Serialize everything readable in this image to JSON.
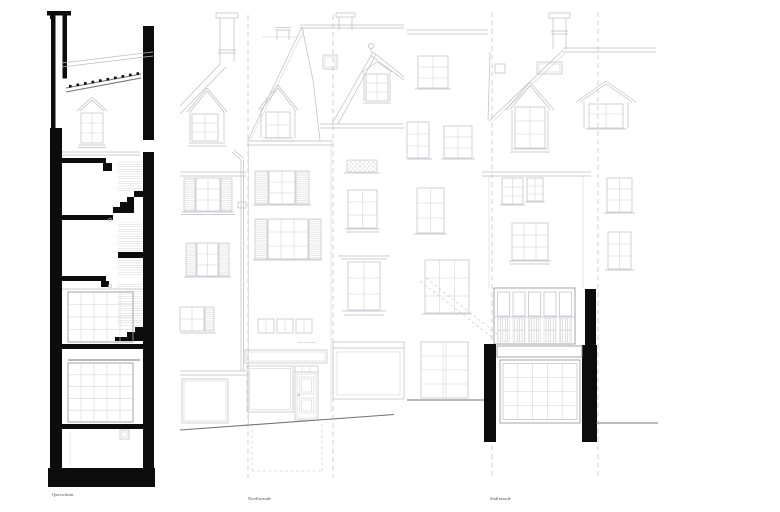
{
  "drawings": [
    {
      "id": "querschnitt",
      "label": "Querschnitt"
    },
    {
      "id": "nordfassade",
      "label": "Nordfassade"
    },
    {
      "id": "suedfassade",
      "label": "Südfassade"
    }
  ],
  "colors": {
    "paper": "#ffffff",
    "ink": "#0c0c0c",
    "line_xlight": "#d4d4d8",
    "line_light": "#bdbdc3",
    "line_mid": "#9c9ca2",
    "line_dark": "#74747b",
    "line_dash": "#c6c6cb",
    "label": "#46464c"
  }
}
